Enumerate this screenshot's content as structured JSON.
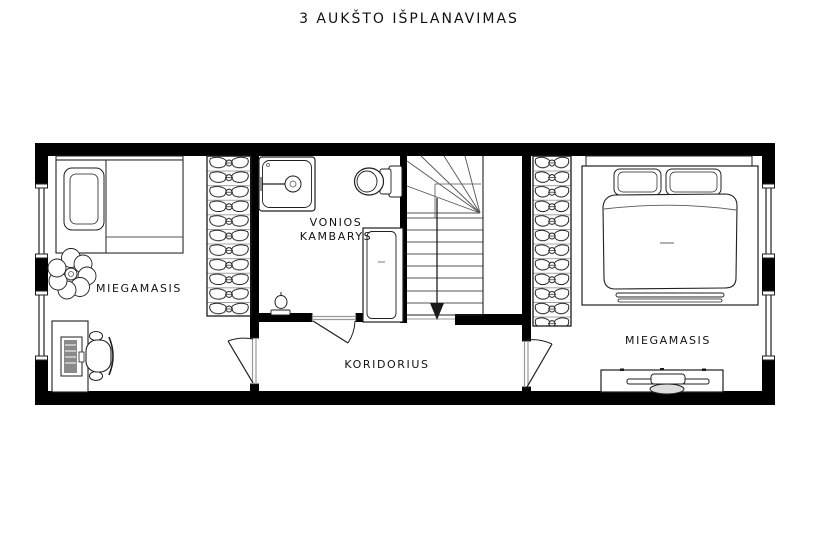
{
  "title": "3 AUKŠTO IŠPLANAVIMAS",
  "rooms": {
    "bedroom_left": {
      "label": "MIEGAMASIS"
    },
    "bathroom": {
      "label_line1": "VONIOS",
      "label_line2": "KAMBARYS"
    },
    "corridor": {
      "label": "KORIDORIUS"
    },
    "bedroom_right": {
      "label": "MIEGAMASIS"
    }
  },
  "colors": {
    "background": "#ffffff",
    "wall": "#000000",
    "line": "#1f1f1f",
    "mid": "#555555",
    "label": "#111111"
  }
}
